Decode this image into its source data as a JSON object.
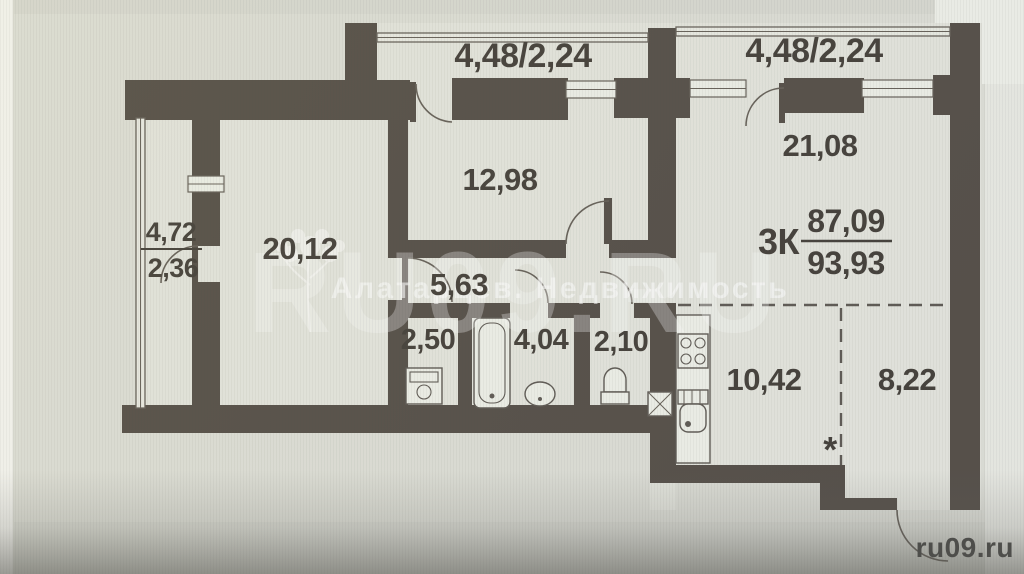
{
  "apartment": {
    "rooms_label": "3К",
    "living_area": "87,09",
    "total_area": "93,93"
  },
  "rooms": {
    "bedroom_left": "20,12",
    "bedroom_top": "12,98",
    "living_room": "21,08",
    "corridor": "5,63",
    "laundry": "2,50",
    "bathroom": "4,04",
    "wc": "2,10",
    "kitchen": "10,42",
    "hall": "8,22"
  },
  "balconies": {
    "left_length": "4,72",
    "left_area": "2,36",
    "top": "4,48/2,24",
    "right": "4,48/2,24"
  },
  "symbols": {
    "asterisk": "*"
  },
  "watermark": {
    "brand": "RU09.RU",
    "agency": "Алатарцев. Недвижимость",
    "site_corner": "ru09.ru"
  }
}
